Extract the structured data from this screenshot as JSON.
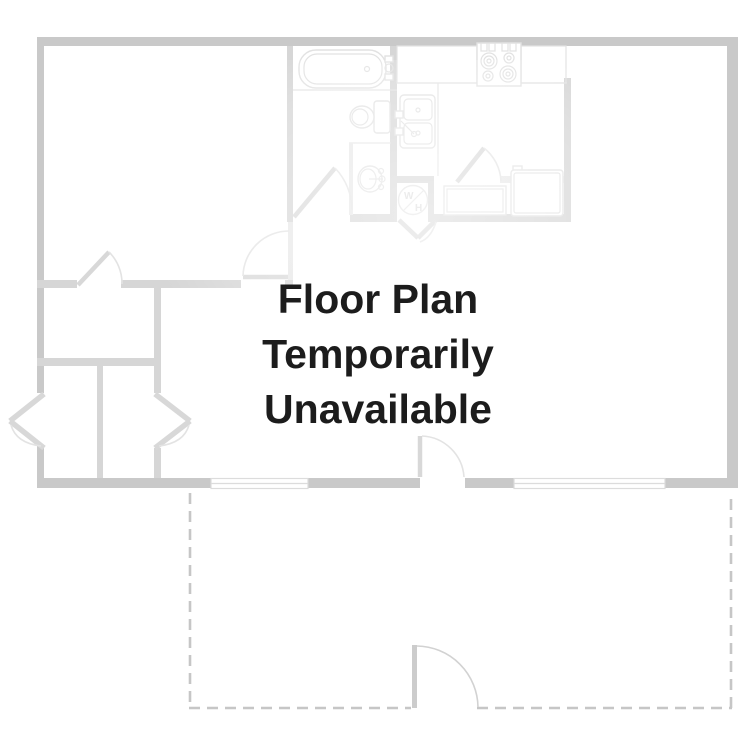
{
  "page": {
    "title": "Floor Plan Temporarily Unavailable",
    "kind": "floor-plan-placeholder"
  },
  "message": {
    "line1": "Floor Plan",
    "line2": "Temporarily",
    "line3": "Unavailable"
  },
  "water_heater": {
    "label_top": "W",
    "label_bottom": "H"
  },
  "fixtures": {
    "names": [
      "bathtub",
      "toilet",
      "pedestal-sink",
      "kitchen-sink",
      "stove",
      "refrigerator",
      "water-heater",
      "base-cabinet",
      "counter",
      "windows",
      "door-swings",
      "patio-dashed-outline"
    ]
  },
  "colors": {
    "outer-wall": "#c9c9c9",
    "inner-wall": "#d6d6d6",
    "faint-wall": "#e7e7e7",
    "fixture-line": "#e2e2e2",
    "door-leaf": "#d8d8d8",
    "door-arc": "#e3e3e3",
    "window-line": "#dcdcdc",
    "dashed-outline": "#c6c6c6",
    "message-text": "#1c1c1c",
    "background": "#ffffff"
  }
}
